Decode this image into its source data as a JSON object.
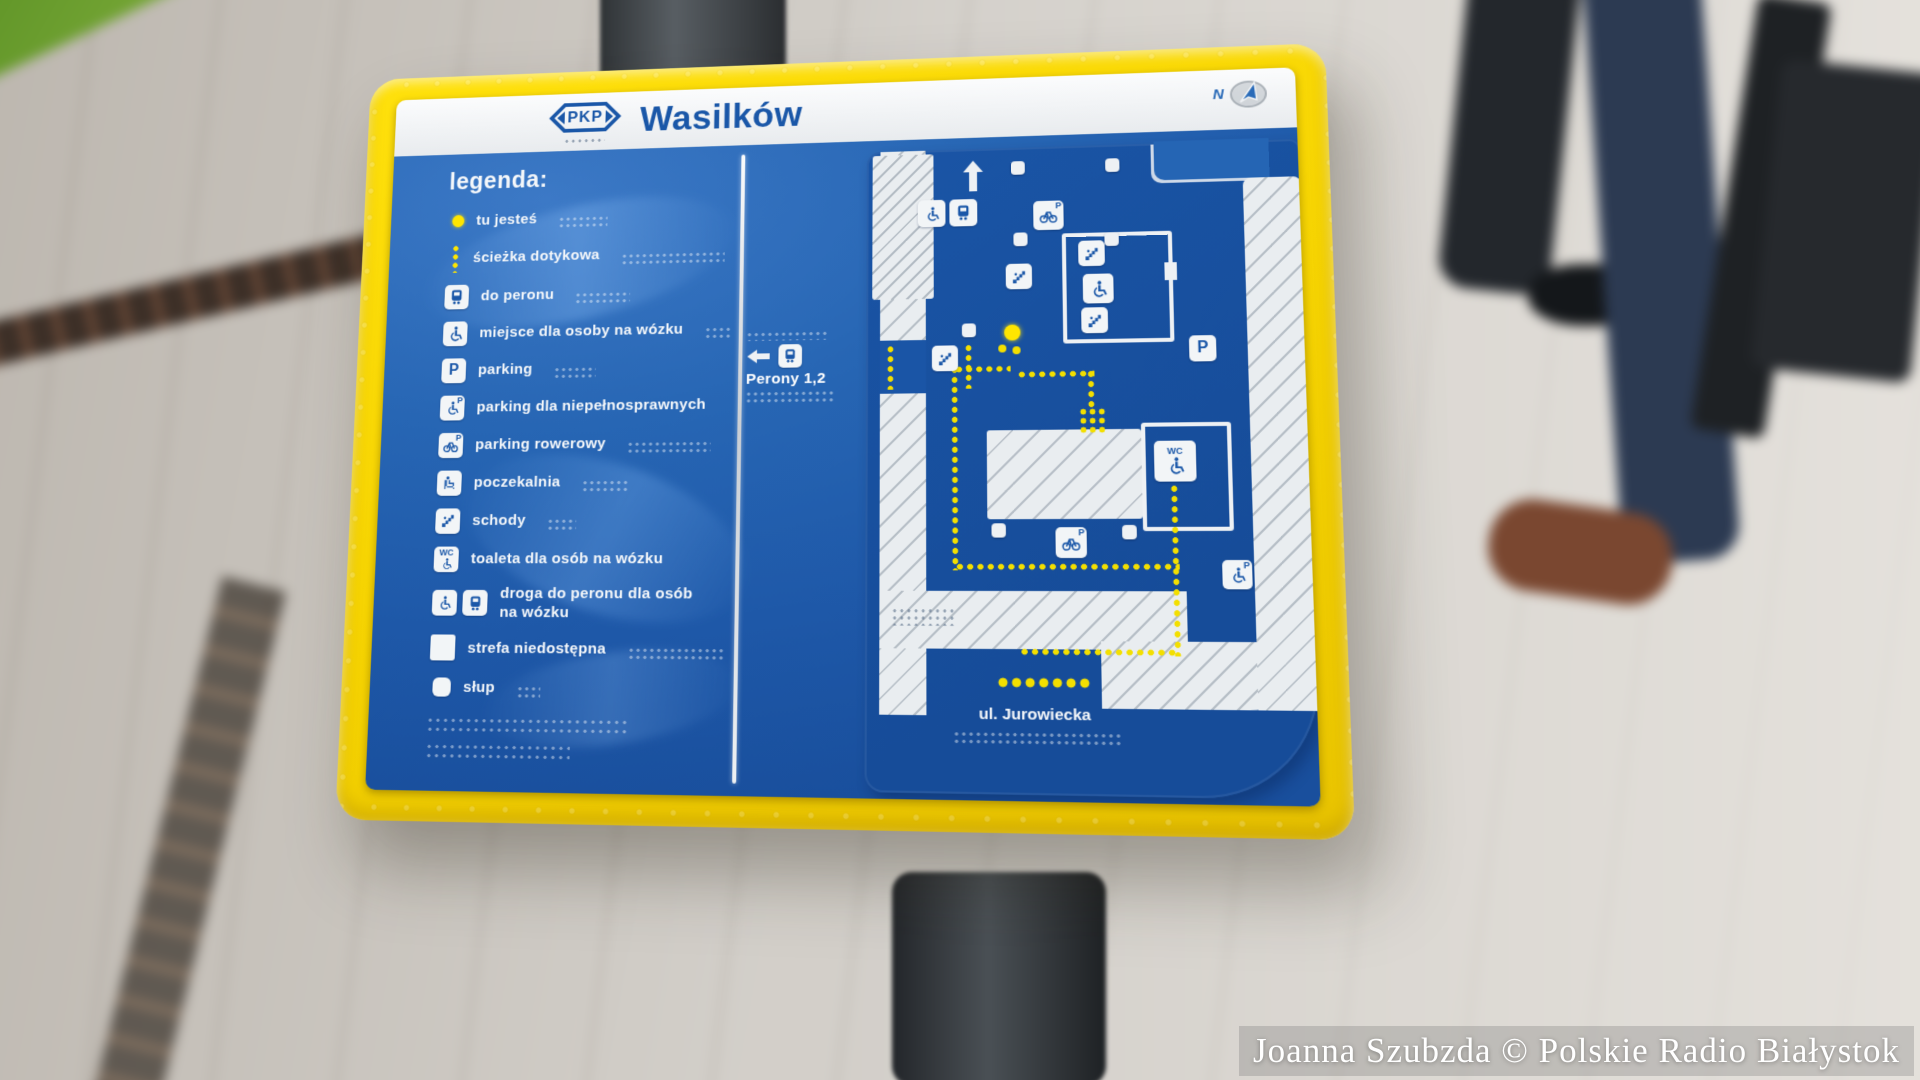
{
  "scene": {
    "watermark": "Joanna Szubzda © Polskie Radio Białystok"
  },
  "sign": {
    "header": {
      "logo": "PKP",
      "station": "Wasilków",
      "compass_letter": "N"
    },
    "legend": {
      "heading": "legenda:",
      "items": [
        {
          "icon": "you-are-here-dot",
          "label": "tu jesteś"
        },
        {
          "icon": "tactile-path",
          "label": "ścieżka dotykowa"
        },
        {
          "icon": "train",
          "label": "do peronu"
        },
        {
          "icon": "wheelchair",
          "label": "miejsce dla osoby na wózku"
        },
        {
          "icon": "parking",
          "label": "parking"
        },
        {
          "icon": "disabled-parking",
          "label": "parking dla niepełnosprawnych"
        },
        {
          "icon": "bike-parking",
          "label": "parking rowerowy"
        },
        {
          "icon": "waiting-room",
          "label": "poczekalnia"
        },
        {
          "icon": "stairs",
          "label": "schody"
        },
        {
          "icon": "accessible-toilet",
          "label": "toaleta dla osób na wózku"
        },
        {
          "icon": "accessible-route",
          "label": "droga do peronu dla osób\nna wózku"
        },
        {
          "icon": "inaccessible-area",
          "label": "strefa niedostępna"
        },
        {
          "icon": "post",
          "label": "słup"
        }
      ]
    },
    "map": {
      "platforms_label": "Perony 1,2",
      "street_label": "ul. Jurowiecka",
      "parking_letter": "P",
      "wc_label": "WC"
    },
    "colors": {
      "frame_yellow": "#f6d402",
      "panel_blue": "#2160ae",
      "plate_blue": "#174f9e",
      "pkp_blue": "#1a57a8",
      "path_yellow": "#ffe600",
      "road_white": "#e9edf0"
    }
  }
}
